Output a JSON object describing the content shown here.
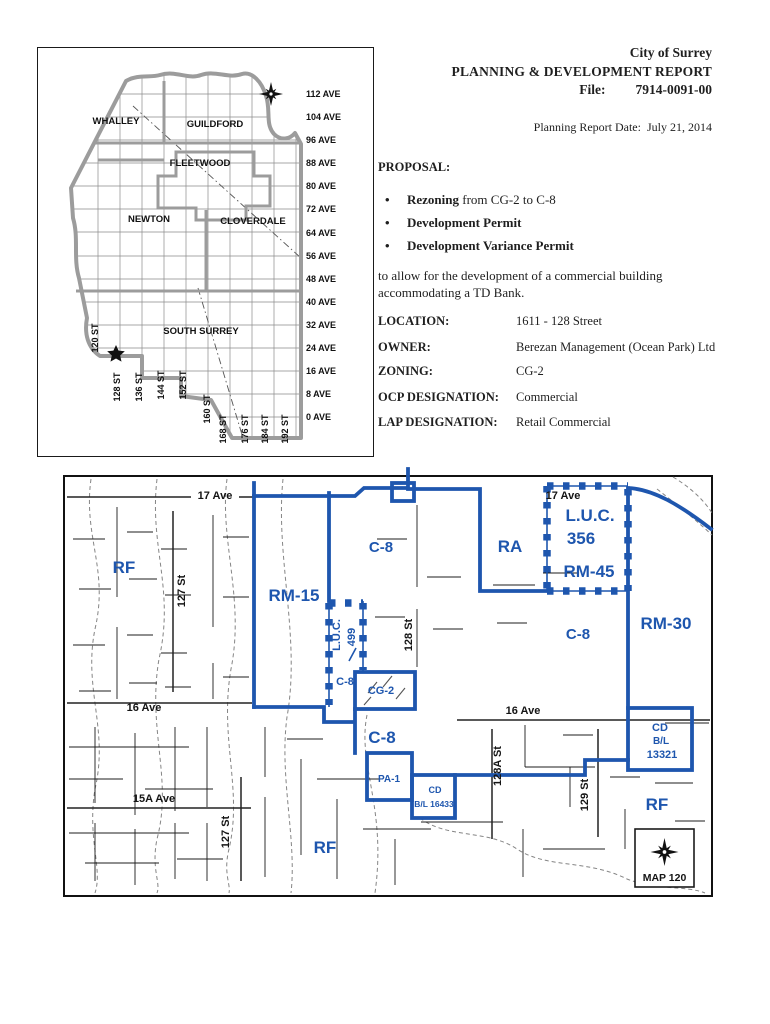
{
  "report": {
    "org": "City of Surrey",
    "title": "PLANNING & DEVELOPMENT REPORT",
    "file_label": "File:",
    "file_number": "7914-0091-00",
    "date_label": "Planning Report Date:",
    "date_value": "July 21, 2014",
    "proposal_heading": "PROPOSAL:",
    "bullets": [
      {
        "bold": "Rezoning",
        "rest": " from CG-2 to C-8"
      },
      {
        "bold": "Development Permit",
        "rest": ""
      },
      {
        "bold": "Development Variance Permit",
        "rest": ""
      }
    ],
    "description": "to allow for the development of a commercial building accommodating a TD Bank.",
    "details": [
      {
        "label": "LOCATION:",
        "value": "1611 - 128 Street"
      },
      {
        "label": "OWNER:",
        "value": "Berezan Management (Ocean Park) Ltd"
      },
      {
        "label": "ZONING:",
        "value": "CG-2"
      },
      {
        "label": "OCP DESIGNATION:",
        "value": "Commercial"
      },
      {
        "label": "LAP DESIGNATION:",
        "value": "Retail Commercial"
      }
    ]
  },
  "locator_map": {
    "regions": {
      "whalley": "WHALLEY",
      "guildford": "GUILDFORD",
      "fleetwood": "FLEETWOOD",
      "newton": "NEWTON",
      "cloverdale": "CLOVERDALE",
      "south_surrey": "SOUTH SURREY"
    },
    "avenues": [
      "112 AVE",
      "104 AVE",
      "96 AVE",
      "88 AVE",
      "80 AVE",
      "72 AVE",
      "64 AVE",
      "56 AVE",
      "48 AVE",
      "40 AVE",
      "32 AVE",
      "24 AVE",
      "16 AVE",
      "8 AVE",
      "0 AVE"
    ],
    "streets": [
      "120 ST",
      "128 ST",
      "136 ST",
      "144 ST",
      "152 ST",
      "160 ST",
      "168 ST",
      "176 ST",
      "184 ST",
      "192 ST"
    ]
  },
  "zoning_map": {
    "map_label": "MAP 120",
    "streets": {
      "ave17_left": "17 Ave",
      "ave17_right": "17 Ave",
      "st127_top": "127 St",
      "st127_bottom": "127 St",
      "st128": "128 St",
      "st128a": "128A St",
      "st129": "129 St",
      "ave16_left": "16 Ave",
      "ave16_right": "16 Ave",
      "ave15a": "15A Ave"
    },
    "zones": {
      "rf_left": "RF",
      "rm15": "RM-15",
      "c8_top": "C-8",
      "luc499_line1": "L.U.C.",
      "luc499_line2": "499",
      "c8_small": "C-8",
      "cg2": "CG-2",
      "c8_mid": "C-8",
      "ra": "RA",
      "luc356_line1": "L.U.C.",
      "luc356_line2": "356",
      "rm45": "RM-45",
      "rm30": "RM-30",
      "c8_right": "C-8",
      "cd13321_line1": "CD",
      "cd13321_line2": "B/L",
      "cd13321_line3": "13321",
      "pa1": "PA-1",
      "cd16433_line1": "CD",
      "cd16433_line2": "B/L 16433",
      "rf_right": "RF",
      "rf_bottom": "RF"
    }
  }
}
